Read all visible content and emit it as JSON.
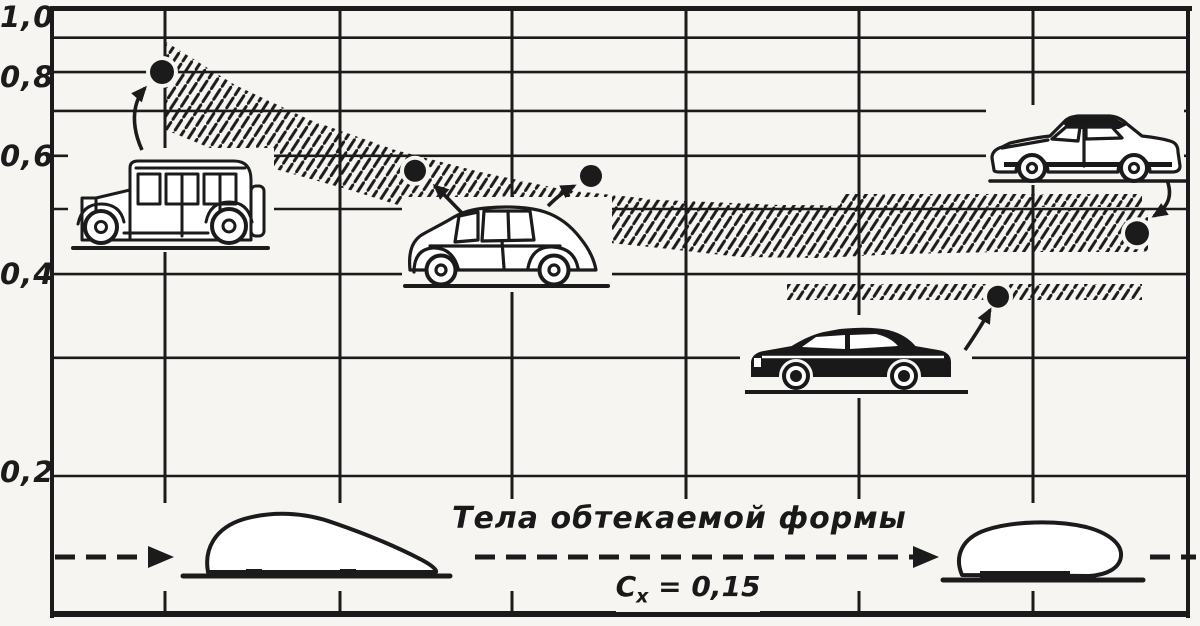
{
  "page": {
    "background_color": "#f6f5f2",
    "ink_color": "#1b1b1b"
  },
  "y_axis": {
    "tick_labels": [
      {
        "text": "1,0",
        "value": 1.0
      },
      {
        "text": "0,8",
        "value": 0.8
      },
      {
        "text": "0,6",
        "value": 0.6
      },
      {
        "text": "0,4",
        "value": 0.4
      },
      {
        "text": "0,2",
        "value": 0.2
      }
    ]
  },
  "captions": {
    "streamlined_bodies": "Тела обтекаемой формы",
    "cx_symbol": "C",
    "cx_subscript": "х",
    "cx_equals_value": "= 0,15"
  },
  "chart_data": {
    "type": "scatter",
    "title": "",
    "xlabel": "",
    "ylabel": "",
    "y_scale": "log",
    "ylim": [
      0.15,
      1.0
    ],
    "grid": "on",
    "legend": "none",
    "y_tick_labels": [
      "1,0",
      "0,8",
      "0,6",
      "0,4",
      "0,2"
    ],
    "y_gridline_values": [
      0.9,
      0.8,
      0.7,
      0.6,
      0.5,
      0.4,
      0.3,
      0.2
    ],
    "points": [
      {
        "car": "1930s boxy sedan",
        "cx": 0.8
      },
      {
        "car": "1940s streamlined fastback (left point)",
        "cx": 0.57
      },
      {
        "car": "1940s streamlined fastback (right point)",
        "cx": 0.56
      },
      {
        "car": "modern dark sedan",
        "cx": 0.37
      },
      {
        "car": "modern compact sedan",
        "cx": 0.46
      }
    ],
    "hatched_bands": [
      {
        "name": "typical-cx-range-band",
        "cx_left_end": [
          0.65,
          0.92
        ],
        "cx_right_end": [
          0.42,
          0.5
        ]
      },
      {
        "name": "low-cx-strip",
        "cx_range": [
          0.365,
          0.385
        ]
      }
    ],
    "annotations": [
      "Тела обтекаемой формы",
      "Cх= 0,15"
    ]
  }
}
